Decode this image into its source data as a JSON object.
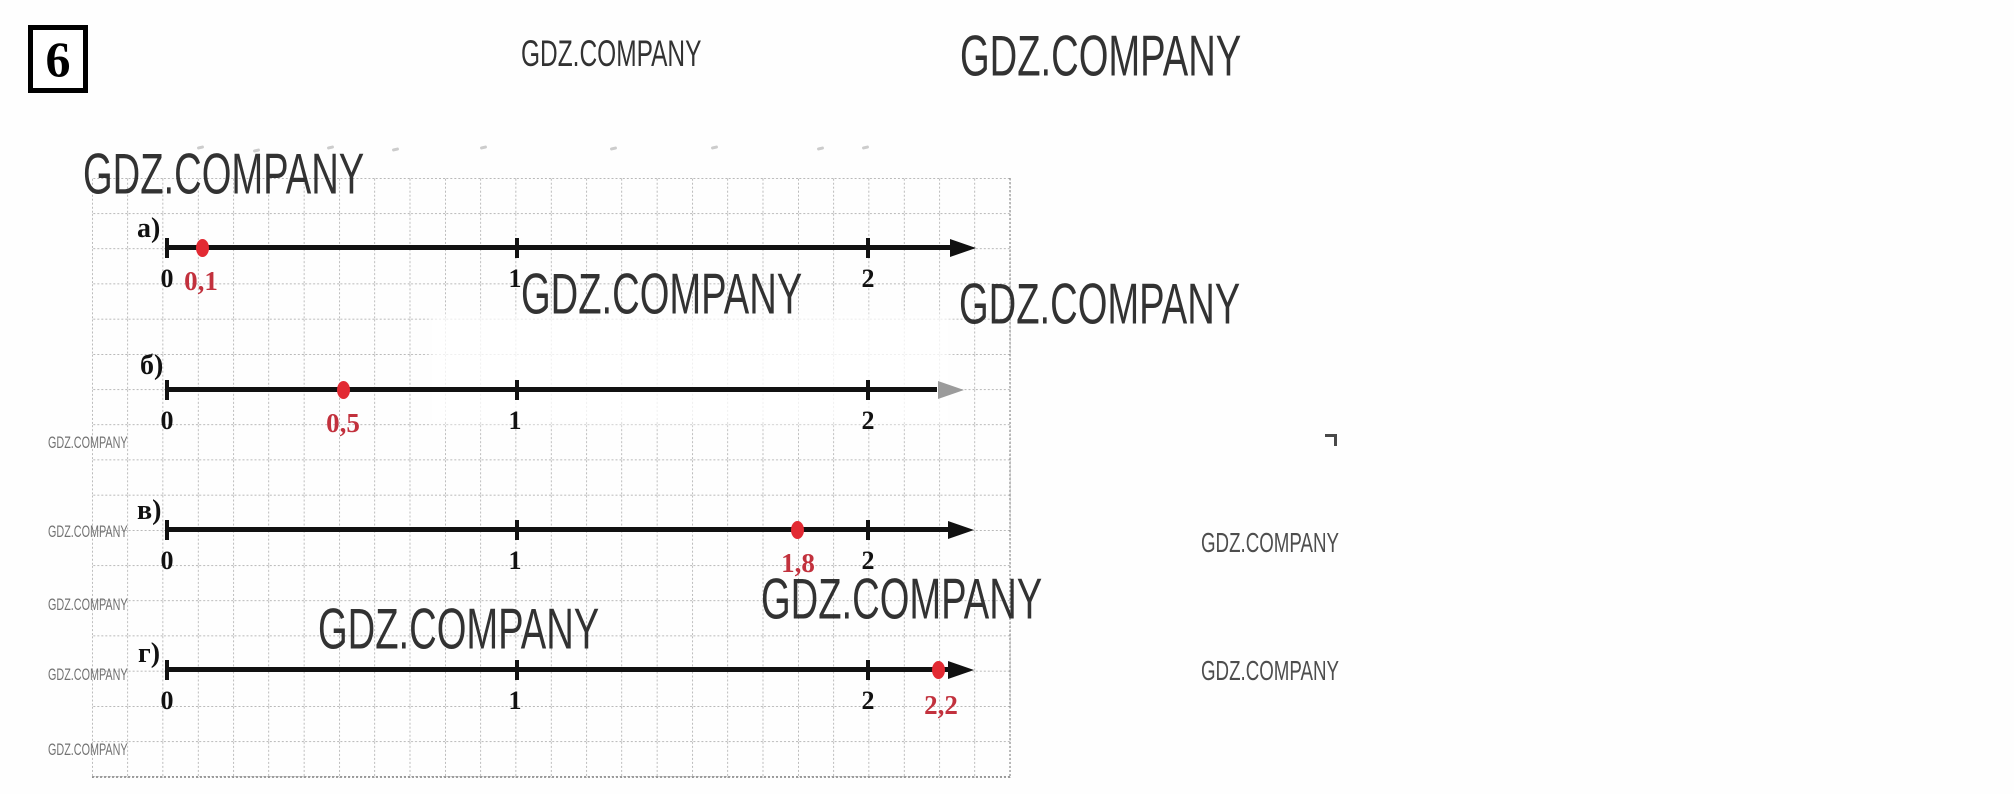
{
  "page": {
    "exercise_number": "6"
  },
  "watermark": {
    "text": "GDZ.COMPANY"
  },
  "colors": {
    "point_red": "#e22a33",
    "label_red": "#c2313d",
    "line_black": "#111111",
    "grid_gray": "#8f8f8f",
    "faded_arrow_gray": "#9b9b9b"
  },
  "number_lines": [
    {
      "label": "а)",
      "ticks": [
        "0",
        "1",
        "2"
      ],
      "point_label": "0,1",
      "point_value": 0.1
    },
    {
      "label": "б)",
      "ticks": [
        "0",
        "1",
        "2"
      ],
      "point_label": "0,5",
      "point_value": 0.5
    },
    {
      "label": "в)",
      "ticks": [
        "0",
        "1",
        "2"
      ],
      "point_label": "1,8",
      "point_value": 1.8
    },
    {
      "label": "г)",
      "ticks": [
        "0",
        "1",
        "2"
      ],
      "point_label": "2,2",
      "point_value": 2.2
    }
  ]
}
